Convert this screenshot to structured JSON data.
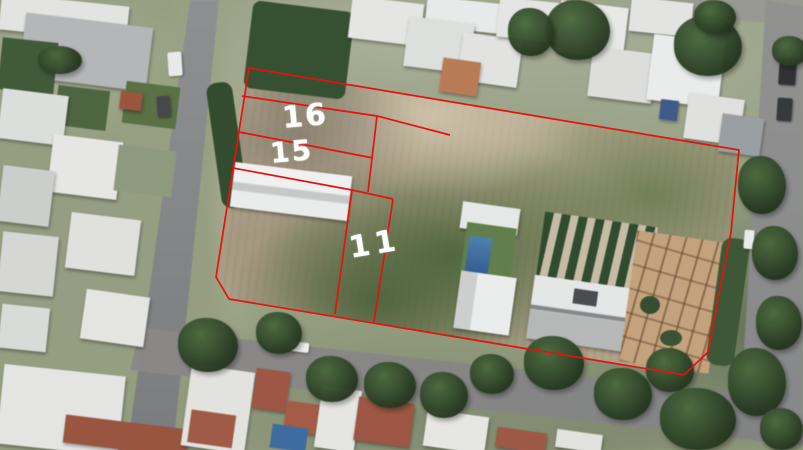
{
  "map": {
    "description": "Aerial satellite view of a suburban block with a red property-boundary overlay marking numbered lots",
    "parcel_labels": [
      "16",
      "15",
      "11"
    ]
  },
  "colors": {
    "boundary": "#e5120d",
    "label": "#ffffff"
  },
  "overlay": {
    "outer": "249,68 739,150 731,232 708,352 684,375 229,299 216,277",
    "inner_lines": [
      "242,96 377,116 450,135",
      "377,116 368,192",
      "239,132 373,158",
      "233,168 352,190",
      "352,190 393,199",
      "352,190 335,314",
      "393,199 374,322"
    ],
    "labels": [
      {
        "text": "16"
      },
      {
        "text": "15"
      },
      {
        "text": "11"
      }
    ]
  }
}
